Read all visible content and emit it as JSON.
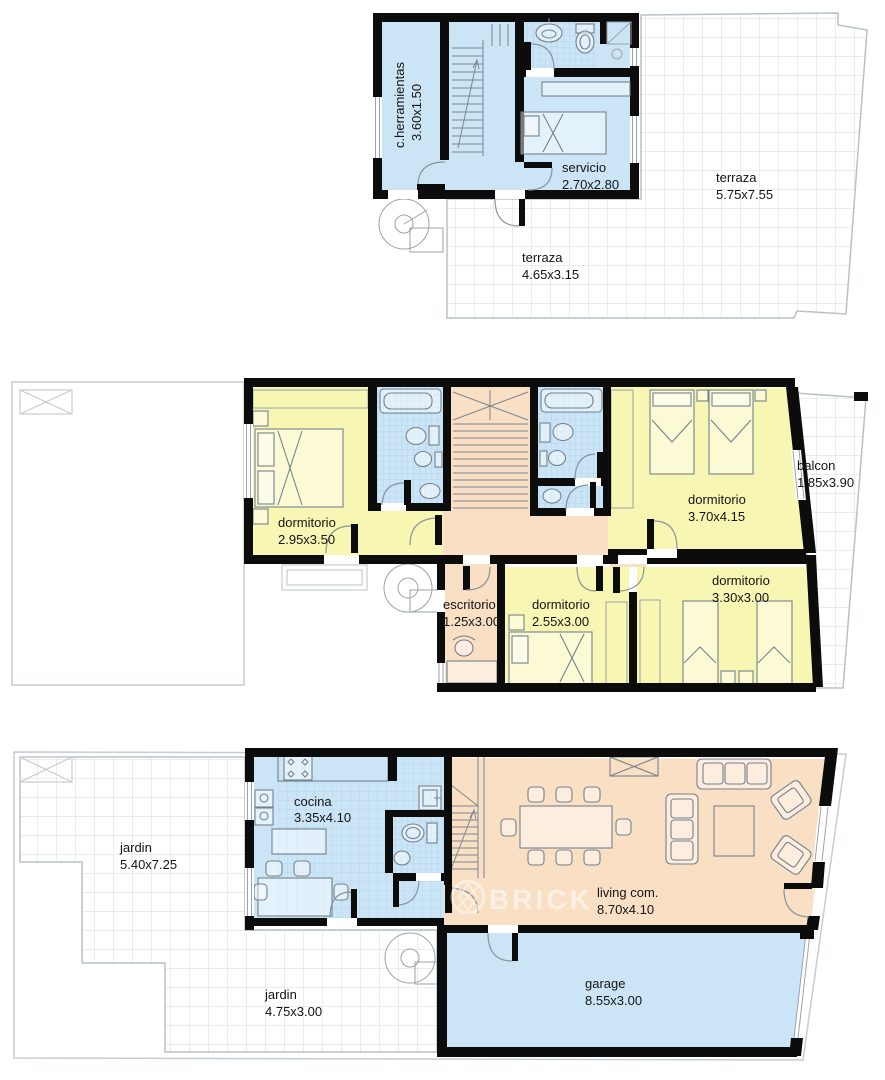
{
  "watermark": {
    "text": "BRICK"
  },
  "colors": {
    "room_blue": "#cbe5f6",
    "room_yellow": "#f7f6b2",
    "room_peach": "#f9dfc3",
    "wall_black": "#0c0c0c",
    "tile_line": "#d5d9de",
    "bath_tile_line": "#a3cbe5",
    "outline_gray": "#b9c0c8",
    "label_color": "#141414",
    "watermark_white": "#ffffff"
  },
  "floors": [
    {
      "id": "upper-floor",
      "rooms": [
        {
          "name": "c.herramientas",
          "dims": "3.60x1.50"
        },
        {
          "name": "servicio",
          "dims": "2.70x2.80"
        },
        {
          "name": "terraza",
          "dims": "5.75x7.55"
        },
        {
          "name": "terraza",
          "dims": "4.65x3.15"
        }
      ]
    },
    {
      "id": "bedroom-floor",
      "rooms": [
        {
          "name": "dormitorio",
          "dims": "2.95x3.50"
        },
        {
          "name": "dormitorio",
          "dims": "3.70x4.15"
        },
        {
          "name": "balcon",
          "dims": "1.85x3.90"
        },
        {
          "name": "dormitorio",
          "dims": "3.30x3.00"
        },
        {
          "name": "dormitorio",
          "dims": "2.55x3.00"
        },
        {
          "name": "escritorio",
          "dims": "1.25x3.00"
        }
      ]
    },
    {
      "id": "ground-floor",
      "rooms": [
        {
          "name": "jardin",
          "dims": "5.40x7.25"
        },
        {
          "name": "cocina",
          "dims": "3.35x4.10"
        },
        {
          "name": "living com.",
          "dims": "8.70x4.10"
        },
        {
          "name": "jardin",
          "dims": "4.75x3.00"
        },
        {
          "name": "garage",
          "dims": "8.55x3.00"
        }
      ]
    }
  ]
}
